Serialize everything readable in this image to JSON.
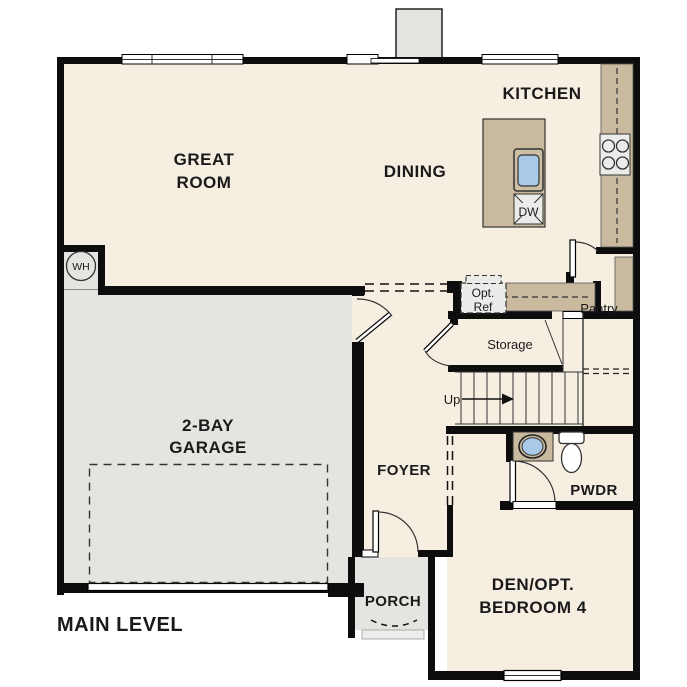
{
  "title": "MAIN LEVEL",
  "rooms": {
    "great_room": {
      "line1": "GREAT",
      "line2": "ROOM"
    },
    "dining": {
      "label": "DINING"
    },
    "kitchen": {
      "label": "KITCHEN"
    },
    "garage": {
      "line1": "2-BAY",
      "line2": "GARAGE"
    },
    "foyer": {
      "label": "FOYER"
    },
    "porch": {
      "label": "PORCH"
    },
    "den": {
      "line1": "DEN/OPT.",
      "line2": "BEDROOM 4"
    },
    "powder": {
      "label": "PWDR"
    },
    "pantry": {
      "label": "Pantry"
    },
    "storage": {
      "label": "Storage"
    }
  },
  "annotations": {
    "stairs_up": "Up",
    "opt_ref_line1": "Opt.",
    "opt_ref_line2": "Ref",
    "dishwasher": "DW",
    "water_heater": "WH"
  },
  "colors": {
    "room_cream": "#f6eee1",
    "garage_gray": "#e6e4e1",
    "porch_step_gray": "#ededeb",
    "counter_tan": "#c9b99e",
    "sink_rim_tan": "#cdbfa4",
    "sink_blue": "#a9c9e9",
    "fixture_gray": "#ebebe9",
    "wall_black": "#0d0d0d"
  }
}
